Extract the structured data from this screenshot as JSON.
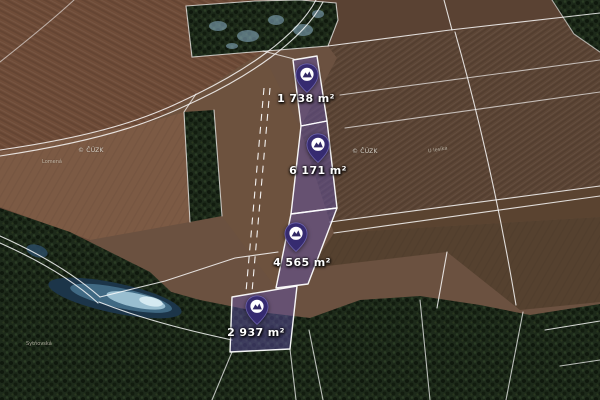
{
  "map": {
    "watermark": "© ČÚZK",
    "parcels": [
      {
        "area": "1 738 m²"
      },
      {
        "area": "6 171 m²"
      },
      {
        "area": "4 565 m²"
      },
      {
        "area": "2 937 m²"
      }
    ],
    "place_labels": [
      {
        "text": "Lomená"
      },
      {
        "text": "U lesíka"
      },
      {
        "text": "Sytňovská"
      }
    ],
    "colors": {
      "parcel_fill": "#6052a8",
      "pin": "#362b70",
      "boundary_line": "#ffffff"
    }
  }
}
